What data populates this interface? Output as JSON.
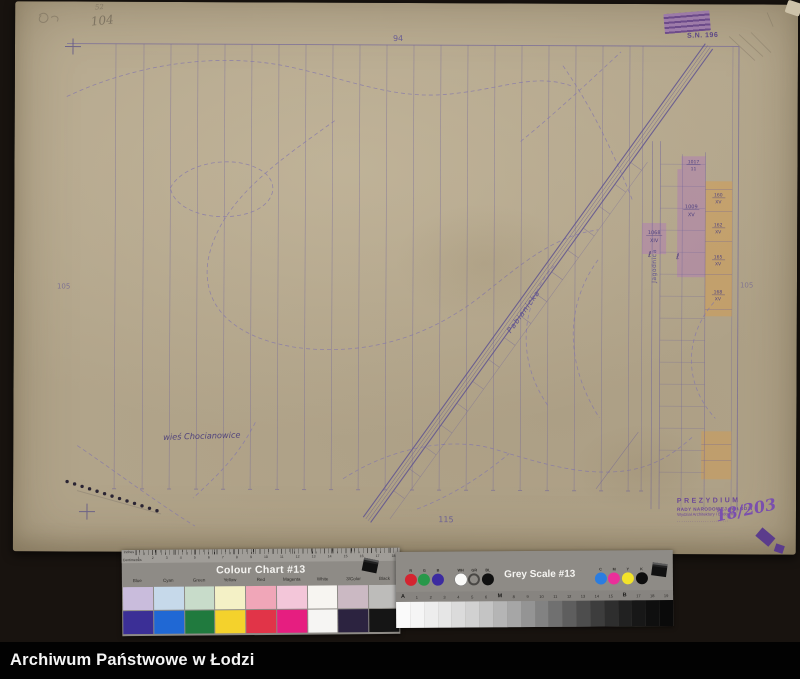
{
  "footer": {
    "text": "Archiwum Państwowe w Łodzi"
  },
  "map": {
    "pencil_note_top": "104",
    "pencil_note_small": "52",
    "stamp_number": "S.N. 196",
    "sheet_numbers": {
      "top": "94",
      "bottom": "115",
      "left": "105",
      "right": "105"
    },
    "village_label": "wieś Chocianowice",
    "road_label": "Pabianicka",
    "street_label": "Jagodnica",
    "section_letter": "ℓ",
    "parcels": [
      {
        "id": "1017",
        "sub": "11"
      },
      {
        "id": "1009",
        "sub": "XV"
      },
      {
        "id": "1068",
        "sub": "XIV"
      },
      {
        "id": "160",
        "sub": "XV"
      },
      {
        "id": "162",
        "sub": "XV"
      },
      {
        "id": "165",
        "sub": "XV"
      },
      {
        "id": "168",
        "sub": "XV"
      }
    ],
    "office_stamp": {
      "line1": "PREZYDIUM",
      "line2": "RADY NARODOWEJ m. ŁODZI",
      "line3": "Wydział Architektury i Budown.",
      "line4": "........................",
      "handwritten": "18/203"
    }
  },
  "colour_chart": {
    "title": "Colour Chart #13",
    "ruler_top_label": "Inches",
    "ruler_bottom_label": "Centimetres",
    "cm_numbers": [
      "1",
      "2",
      "3",
      "4",
      "5",
      "6",
      "7",
      "8",
      "9",
      "10",
      "11",
      "12",
      "13",
      "14",
      "15",
      "16",
      "17",
      "18"
    ],
    "columns": [
      "Blue",
      "Cyan",
      "Green",
      "Yellow",
      "Red",
      "Magenta",
      "White",
      "3/Color",
      "Black"
    ],
    "pastel": [
      "#c9bcdc",
      "#c6d9ea",
      "#c8dcca",
      "#f4f1c6",
      "#f0a6b8",
      "#f3c6d9",
      "#f7f5f1",
      "#cbb9c3",
      "#bdbcba"
    ],
    "solid": [
      "#3b2f96",
      "#2068d4",
      "#207a3e",
      "#f4d22c",
      "#e13448",
      "#e61e80",
      "#f6f5f3",
      "#2c2340",
      "#151515"
    ]
  },
  "grey_scale": {
    "title": "Grey Scale #13",
    "dots": [
      {
        "label": "R",
        "color": "#d42430"
      },
      {
        "label": "G",
        "color": "#28984a"
      },
      {
        "label": "B",
        "color": "#3c2ba0"
      },
      {
        "label": "WH",
        "color": "#fafaf8"
      },
      {
        "label": "GR",
        "color": "ring"
      },
      {
        "label": "BL",
        "color": "#101010"
      },
      {
        "label": "C",
        "color": "#2b7de0"
      },
      {
        "label": "M",
        "color": "#ea2f9a"
      },
      {
        "label": "Y",
        "color": "#f2e32a"
      },
      {
        "label": "K",
        "color": "#0e0e0e"
      }
    ],
    "step_labels": [
      "A",
      "1",
      "2",
      "3",
      "4",
      "5",
      "6",
      "M",
      "8",
      "9",
      "10",
      "11",
      "12",
      "13",
      "14",
      "15",
      "B",
      "17",
      "18",
      "19"
    ],
    "step_lightness": [
      98,
      96,
      93,
      90,
      86,
      82,
      77,
      71,
      65,
      58,
      51,
      44,
      37,
      30,
      24,
      18,
      13,
      9,
      6,
      4
    ]
  }
}
